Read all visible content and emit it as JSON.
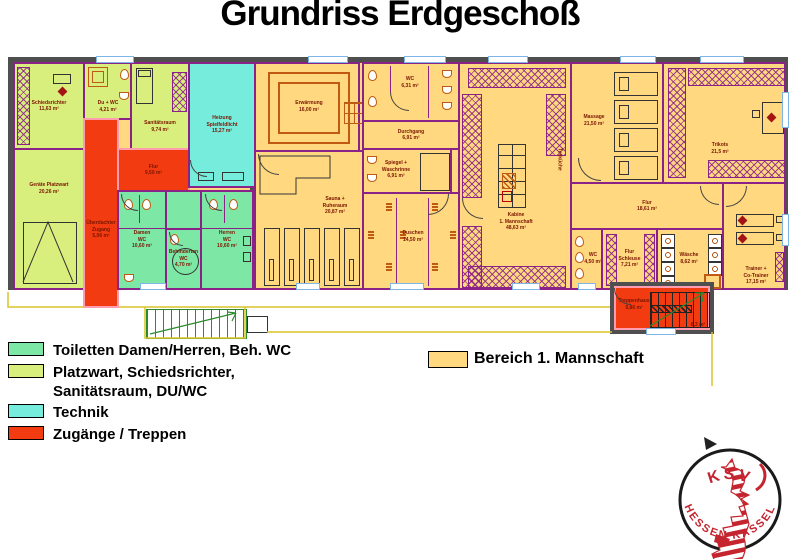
{
  "title": "Grundriss Erdgeschoß",
  "colors": {
    "orange": "#FFD880",
    "green": "#7DE8A6",
    "yellowgreen": "#D9EF7D",
    "cyan": "#76EDDC",
    "red": "#F23B10",
    "wall_dark": "#4F4F4F",
    "wall_purple": "#8B2287",
    "wall_pink": "#FF9DB0",
    "label": "#7A1500",
    "fixture": "#C05A12",
    "stairs_green": "#2E8B2E",
    "terrace_yellow": "#D8C428",
    "window_blue": "#7EB6E8",
    "logo_red": "#C4252F"
  },
  "legend": {
    "items": [
      {
        "label": "Toiletten Damen/Herren, Beh. WC"
      },
      {
        "label": "Platzwart, Schiedsrichter,\nSanitätsraum, DU/WC"
      },
      {
        "label": "Technik"
      },
      {
        "label": "Zugänge / Treppen"
      }
    ],
    "bereich": "Bereich 1. Mannschaft"
  },
  "rooms": {
    "schiedsrichter": "Schiedsrichter\n11,63 m²",
    "du_wc": "Du + WC\n4,21 m²",
    "sanitaetsraum": "Sanitätsraum\n9,74 m²",
    "geraete_platzwart": "Geräte Platzwart\n20,26 m²",
    "flur_links": "Flur\n9,50 m²",
    "ueberdachter_zugang": "Überdachter\nZugang\n5,06 m²",
    "heizung": "Heizung\nSpielfeldlicht\n15,27 m²",
    "damen_wc": "Damen\nWC\n10,60 m²",
    "behinderten_wc": "Behinderten\nWC\n4,70 m²",
    "herren_wc": "Herren\nWC\n10,60 m²",
    "erwaermung": "Erwärmung\n16,00 m²",
    "sauna": "Sauna +\nRuheraum\n20,87 m²",
    "wc_kabine": "WC\n6,31 m²",
    "durchgang": "Durchgang\n6,91 m²",
    "spiegel": "Spiegel +\nWaschrinne\n6,91 m²",
    "duschen": "Duschen\n14,50 m²",
    "kabine": "Kabine\n1. Mannschaft\n48,63 m²",
    "teekueche": "Teeküche",
    "massage": "Massage\n21,50 m²",
    "trikots": "Trikots\n21,5 m²",
    "flur_rechts": "Flur\n18,61 m²",
    "wc_trainer": "WC\n4,50 m²",
    "flur_schleuse": "Flur\nSchleuse\n7,21 m²",
    "waesche": "Wäsche\n8,62 m²",
    "trainer": "Trainer +\nCo-Trainer\n17,15 m²",
    "treppenhaus": "Treppenhaus\n9,86 m²",
    "terrasse": "6,3 m²"
  },
  "logo": {
    "top": "KSV",
    "bottom": "HESSEN KASSEL"
  }
}
